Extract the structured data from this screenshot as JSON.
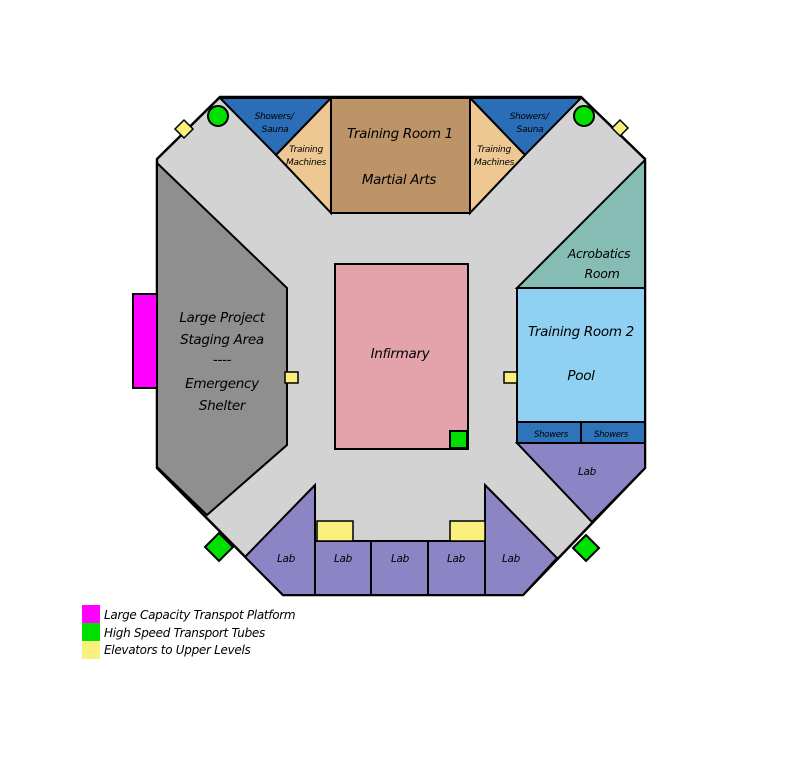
{
  "map": {
    "corridor_color": "#d3d3d3",
    "outline_color": "#000000",
    "rooms": {
      "staging_area": {
        "lines": [
          "Large Project",
          "Staging Area",
          "----",
          "Emergency",
          "Shelter"
        ],
        "color": "#8f8f8f"
      },
      "showers_sauna": {
        "line1": "Showers/",
        "line2": "Sauna",
        "color": "#2b6db7"
      },
      "training_machines": {
        "line1": "Training",
        "line2": "Machines",
        "color": "#edc892"
      },
      "training_room_1": {
        "line1": "Training Room 1",
        "line2": "Martial Arts",
        "color": "#bc9468"
      },
      "acrobatics_room": {
        "line1": "Acrobatics",
        "line2": "Room",
        "color": "#85bdb5"
      },
      "training_room_2": {
        "line1": "Training Room 2",
        "line2": "Pool",
        "color": "#8fd0f3"
      },
      "showers_row": {
        "left": "Showers",
        "right": "Showers",
        "color": "#2e74ba"
      },
      "infirmary": {
        "label": "Infirmary",
        "color": "#e4a2ab"
      },
      "labs": {
        "color": "#8b85c6",
        "label_right": "Lab",
        "label_1": "Lab",
        "label_2": "Lab",
        "label_3": "Lab",
        "label_4": "Lab",
        "label_5": "Lab"
      }
    }
  },
  "legend": {
    "items": [
      {
        "label": "Large Capacity Transpot Platform",
        "color": "#ff00ff"
      },
      {
        "label": "High Speed Transport Tubes",
        "color": "#00e000"
      },
      {
        "label": "Elevators to Upper Levels",
        "color": "#f9f07e"
      }
    ]
  }
}
